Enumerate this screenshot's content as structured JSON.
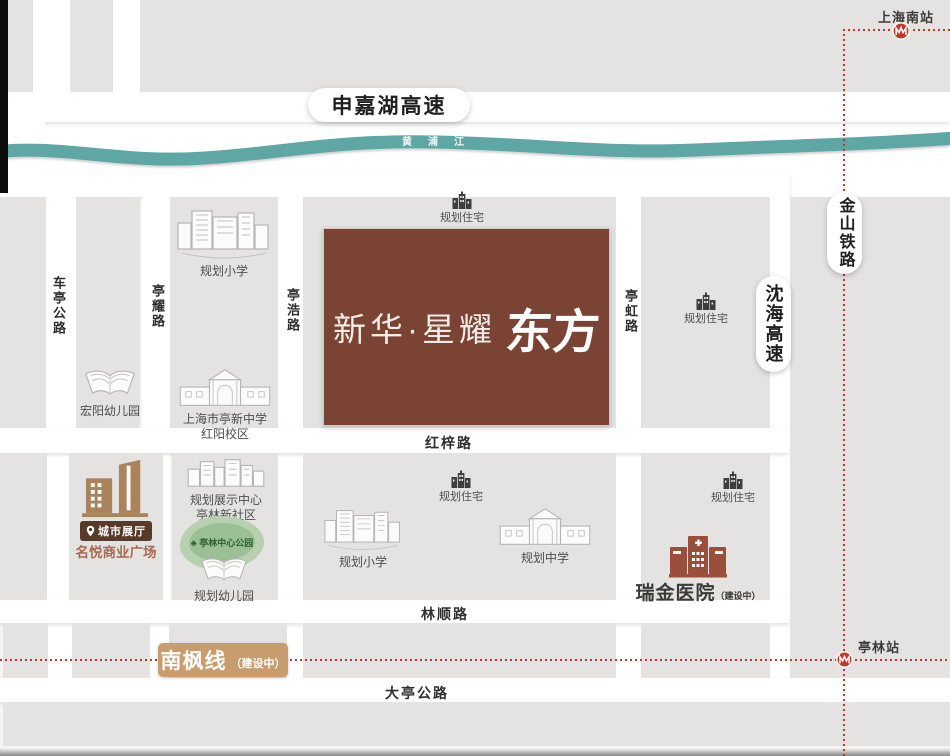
{
  "project": {
    "name_prefix": "新华·星耀",
    "name_suffix": "东方",
    "box_color": "#7a4334"
  },
  "highways": {
    "shenjiahu": "申嘉湖高速",
    "shenhai": "沈海高速"
  },
  "railways": {
    "jinshan": "金山铁路",
    "nanfeng": "南枫线",
    "nanfeng_status": "（建设中）",
    "line_color": "#c0392b"
  },
  "stations": {
    "shanghai_south": "上海南站",
    "tinglin": "亭林站"
  },
  "river": {
    "name": "黄浦江",
    "color": "#5ea7a4"
  },
  "roads": {
    "cheting": "车亭公路",
    "tingyao": "亭耀路",
    "tinghao": "亭浩路",
    "tinghong": "亭虹路",
    "hongzi": "红梓路",
    "linshun": "林顺路",
    "dating": "大亭公路"
  },
  "pois": {
    "planned_housing": "规划住宅",
    "planned_primary": "规划小学",
    "planned_middle": "规划中学",
    "planned_kindergarten": "规划幼儿园",
    "hongyang_kindergarten": "宏阳幼儿园",
    "tingxin_school_line1": "上海市亭新中学",
    "tingxin_school_line2": "红阳校区",
    "exhibition_line1": "规划展示中心",
    "exhibition_line2": "亭林新社区",
    "park": "亭林中心公园",
    "city_hall_badge": "城市展厅",
    "mingyue_plaza": "名悦商业广场",
    "ruijin_hospital": "瑞金医院",
    "ruijin_status": "（建设中）"
  },
  "colors": {
    "block_gray": "#e4e3e2",
    "nanfeng_tan": "#c89c6d",
    "badge_brown": "#573a28",
    "plaza_building_tan": "#a8835c",
    "plaza_text": "#a76950",
    "hospital_brown": "#9a4e3b",
    "housing_icon_dark": "#3e3e3e"
  }
}
